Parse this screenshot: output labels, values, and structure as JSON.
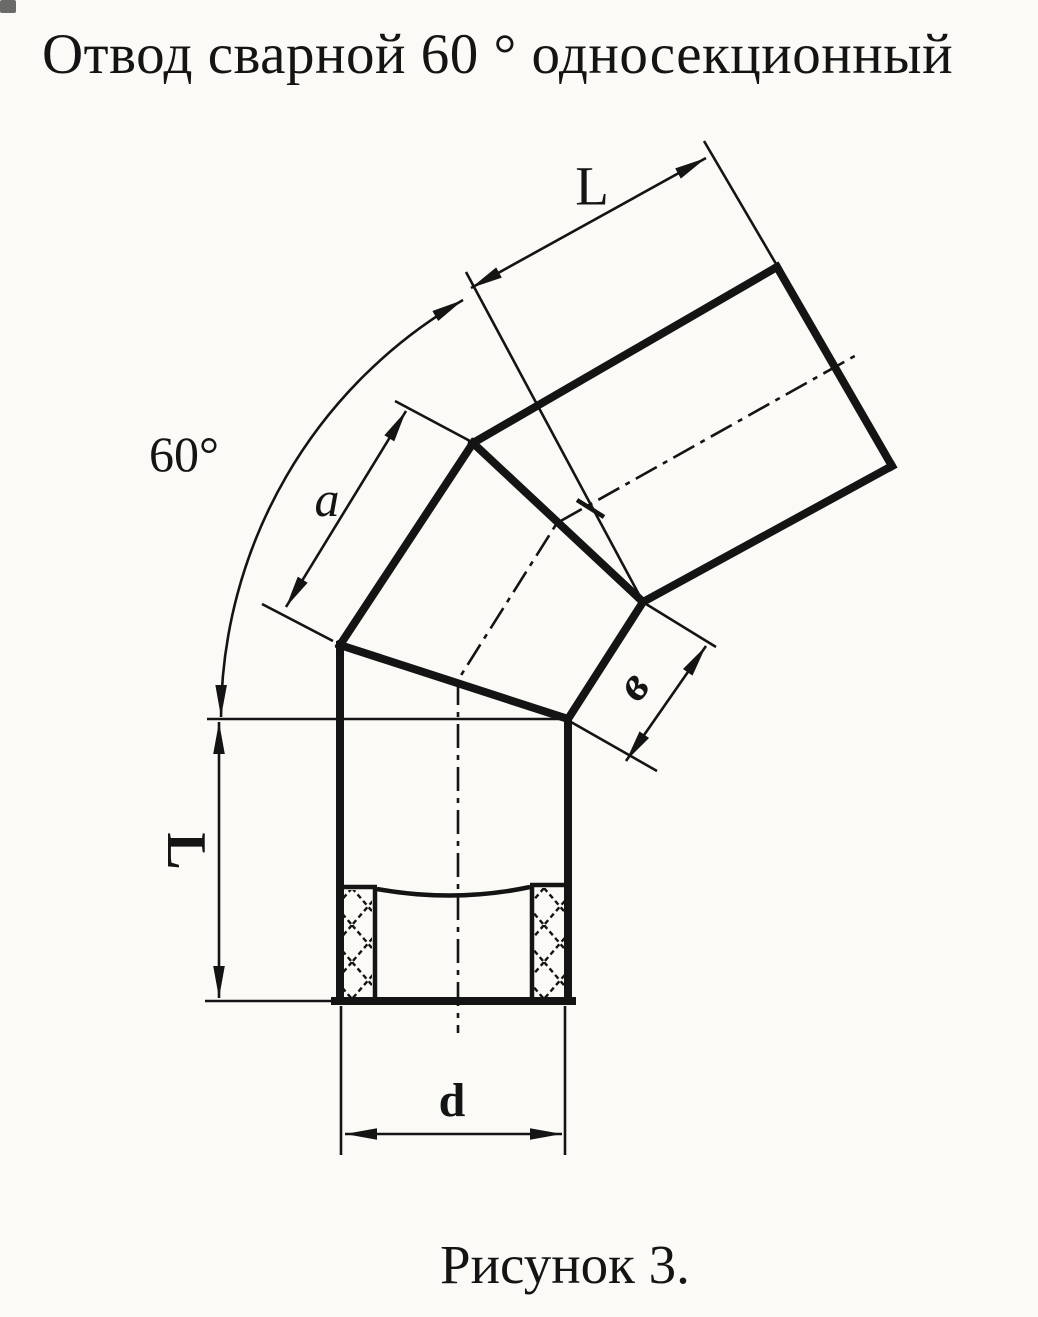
{
  "title": "Отвод сварной 60 ° односекционный",
  "caption": "Рисунок 3.",
  "labels": {
    "angle": "60°",
    "length_top": "L",
    "length_side": "L",
    "segment_a": "a",
    "segment_v": "в",
    "diameter_d": "d"
  },
  "colors": {
    "ink": "#141414",
    "paper": "#fbfaf7"
  }
}
